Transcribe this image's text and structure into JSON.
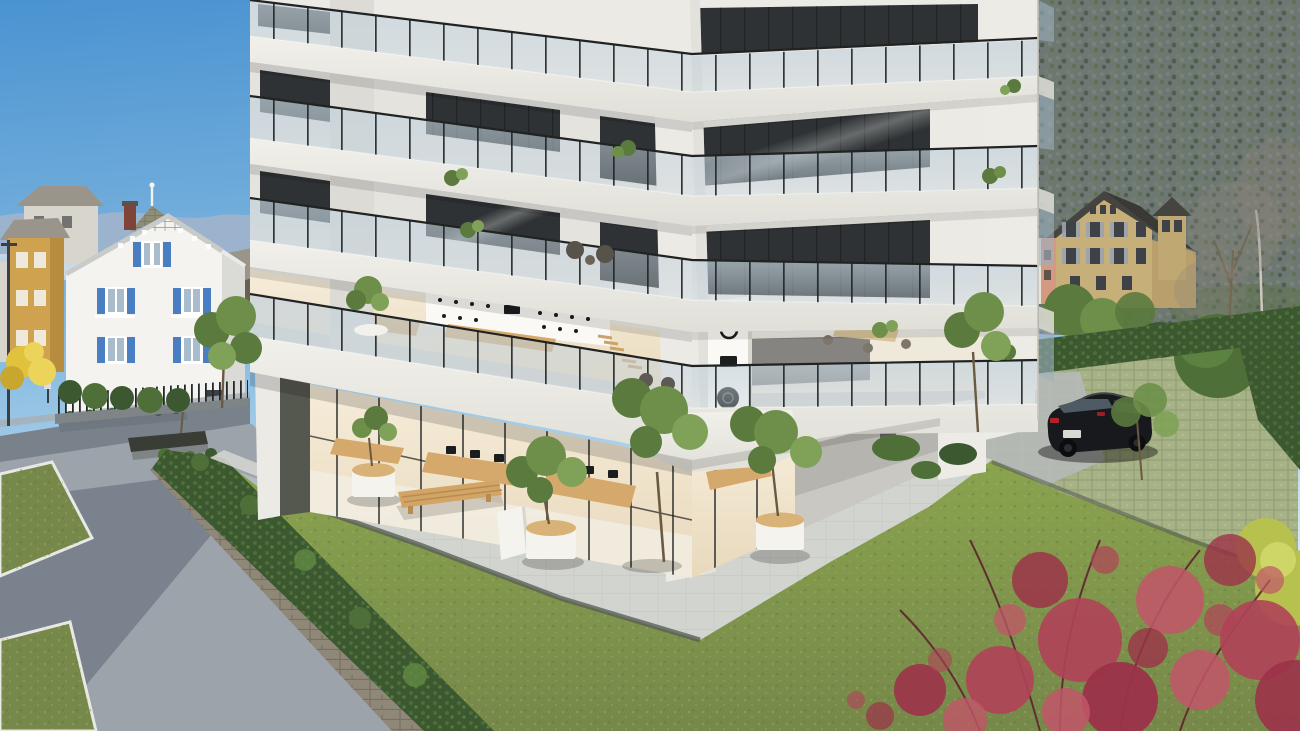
{
  "image": {
    "kind": "architectural-exterior-rendering",
    "width": 1300,
    "height": 731,
    "description": "Photorealistic rendering of a modern multi-storey apartment building with wraparound glass balconies and a ground-floor showroom, fronted by a lawn and paved plaza; a white house with blue shutters stands on the left, a black estate car is parked on green pavers to the right, village houses and a forested mountainside rise in the background under a clear blue sky."
  },
  "colors": {
    "skyTop": "#4a93d1",
    "skyMid": "#8abde2",
    "skyLow": "#cfe3f1",
    "skyHorizon": "#e8f1f7",
    "mountainFar": "#9db3cb",
    "mountainNear": "#b6c6d8",
    "haze": "#d3dfea",
    "forestBase": "#6d7872",
    "forestDark": "#4d5a50",
    "forestMid": "#707d6f",
    "forestLight": "#7c8577",
    "forestGreen": "#5d7046",
    "slabLight": "#f1f0ea",
    "slabMid": "#e0dfd8",
    "slabShadow": "#bcbbb4",
    "facadeWhite": "#eceae5",
    "facadeShade": "#dcdbd5",
    "pierLit": "#edebe5",
    "glassDark": "#2e3234",
    "frameDark": "#1c1e1e",
    "railGlass": "#c3d2dc",
    "railPost": "#202322",
    "warmLight": "#f6ecd9",
    "warmDeep": "#e8d9bc",
    "interiorFloor": "#f2ede3",
    "woodTable": "#d4a96b",
    "displayWhite": "#faf9f5",
    "productDark": "#1b1d1e",
    "deck": "#d7d6d0",
    "paving": "#d2d4cf",
    "pavingLine": "#bfc2bc",
    "curbDark": "#5a5f56",
    "curbWhite": "#e8e8e4",
    "plaza": "#9ca3ab",
    "plazaLit": "#b4bac0",
    "plazaShadow": "#5f6875",
    "roadDark": "#79818b",
    "sidewalk": "#a8aeb4",
    "medianDark": "#6f7780",
    "grassLit": "#8aa44e",
    "grassBase": "#76884a",
    "grassDark": "#5f7340",
    "grassSpeck": "#9aad62",
    "hedgeDark": "#3c5831",
    "hedgeMid": "#4e7038",
    "hedgeLight": "#618a44",
    "wallStone": "#8f8878",
    "wallStoneDark": "#6f695c",
    "houseWhite": "#f4f3ef",
    "houseShade": "#dadbd6",
    "roofGray": "#8e8d76",
    "bargeGray": "#c9cbc9",
    "shutterBlue": "#4a7ec2",
    "paneGlass": "#a9bccb",
    "chimneyBrick": "#7e4438",
    "yellowHouse": "#cfa24f",
    "bgGray": "#9a948a",
    "bgRoofBrown": "#6b5f52",
    "bgPale": "#d8d5cc",
    "tanHouse": "#c7af7a",
    "tanShade": "#b89f6c",
    "tanRoof": "#46443f",
    "shutterGray": "#9aa3ad",
    "salmonHouse": "#d29a80",
    "carBody": "#17191d",
    "carGlass": "#4e5a64",
    "carHighlight": "#3f464c",
    "tailRed": "#b3202a",
    "plateWhite": "#d8d8d4",
    "wheelDark": "#0c0d0f",
    "parkPaver": "#a8b287",
    "parkLine": "#8a9a6e",
    "parkGray": "#b4b8b2",
    "redBloom1": "#9c3249",
    "redBloom2": "#b04258",
    "redBloom3": "#c25568",
    "branchDark": "#5e2430",
    "yellowBush": "#b6c14e",
    "yellowBushLight": "#cdd667",
    "treeGreen1": "#6d8f4a",
    "treeGreen2": "#5a7a3e",
    "treeGreen3": "#7fa258",
    "trunkBrown": "#6b5a42",
    "planterWhite": "#f4f3ee",
    "planterWood": "#d9b277",
    "benchWood": "#d2a566",
    "benchLine": "#b88b50",
    "benchDark": "#3a3c36",
    "underpassWall": "#b5b4ae",
    "underpassFloor": "#c9c8c2",
    "underpassShade": "#83837d",
    "recessDark": "#55584f",
    "fenceDark": "#23282a",
    "fenceBase": "#7f8487",
    "lampPole": "#3a3f41"
  },
  "scene": {
    "labels": {
      "sky": "clear blue sky",
      "mountainsLeft": "distant blue mountain ridges",
      "mountainForest": "forested mountainside",
      "bgBuildingsLeft": "village buildings behind the white house",
      "whiteHouse": "white house with blue shutters and gray roof",
      "streetLeft": "street with median, metal fence and lamp post",
      "plaza": "shaded paved plaza with grass patches",
      "bench": "stone bench at plaza edge",
      "retainingHedge": "stone retaining wall topped by a hedge",
      "lawn": "large green lawn",
      "pavedApron": "light paved terrace around the building base",
      "planters": "white cylindrical planters with small trees",
      "outdoorBench": "long wooden bench on the terrace",
      "signPanel": "freestanding white panel",
      "building": "modern apartment building with wraparound balconies",
      "balconies": "glass balustrade balconies with plants",
      "showroomGround": "glazed ground-floor showroom with wooden tables and screens",
      "showroomMezzanine": "mezzanine showroom with product display wall",
      "cornerDisplayPanel": "tall white display panel with audio products",
      "terrace": "first-floor wraparound terrace",
      "underpass": "covered passage under the right wing",
      "parking": "parking area on green grass pavers",
      "car": "black estate car",
      "hedges": "tall trimmed hedges around the parking",
      "tanHouse": "beige gabled house with shuttered windows",
      "salmonHouse": "salmon-colored building",
      "treesRight": "bare and leafy trees on the right",
      "redBush": "red flowering shrub in the foreground",
      "yellowBush": "yellow-green shrub at the right edge"
    }
  }
}
